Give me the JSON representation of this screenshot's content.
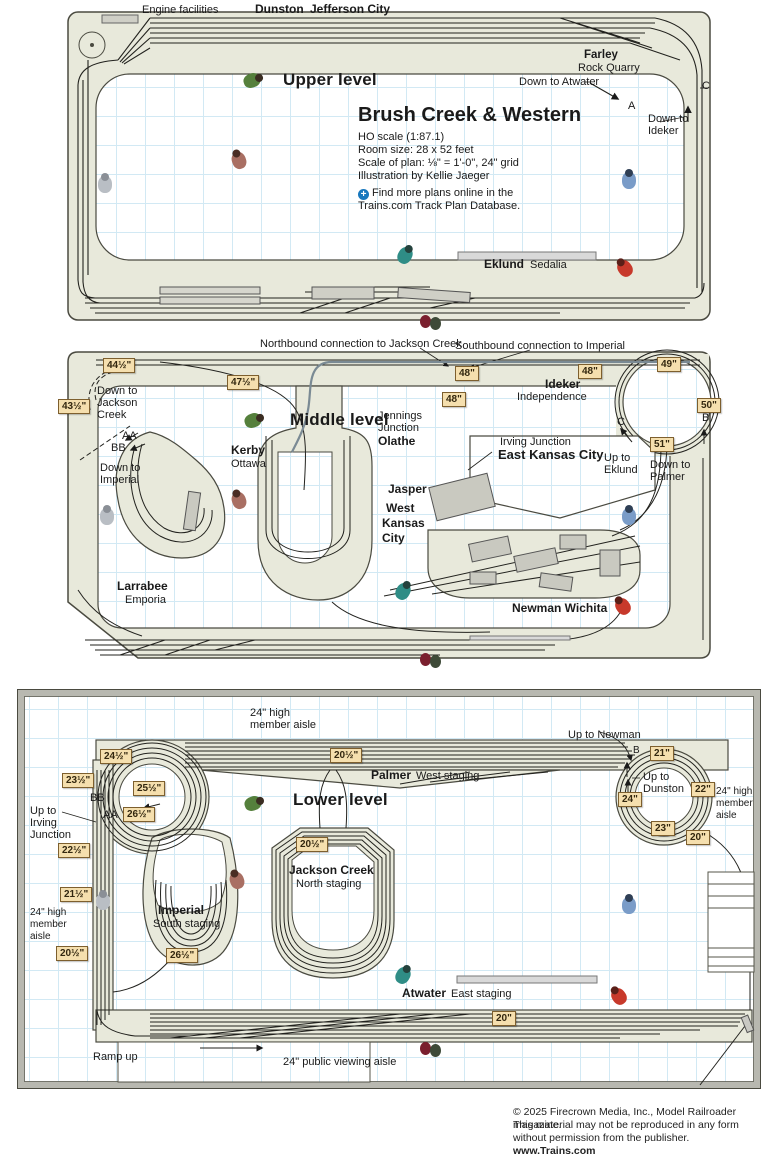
{
  "title_block": {
    "title": "Brush Creek & Western",
    "scale": "HO scale (1:87.1)",
    "room_size": "Room size: 28 x 52 feet",
    "plan_scale": "Scale of plan: ⅛\" = 1'-0\", 24\" grid",
    "illustration": "Illustration by Kellie Jaeger",
    "promo_1": "Find more plans online in the",
    "promo_2": "Trains.com Track Plan Database."
  },
  "glyphs": {
    "plus": "+"
  },
  "colors": {
    "benchwork": "#e8e9db",
    "grid_line": "#d2e9f4",
    "badge_bg": "#f5dfae",
    "badge_border": "#7d5f2e",
    "track": "#22221e",
    "accent_blue": "#1878be"
  },
  "upper": {
    "engine_facilities": "Engine facilities",
    "dunston": "Dunston",
    "jefferson_city": "Jefferson City",
    "level": "Upper level",
    "farley": "Farley",
    "rock_quarry": "Rock Quarry",
    "down_to_atwater": "Down to Atwater",
    "point_a": "A",
    "point_c": "C",
    "down_to_ideker_1": "Down to",
    "down_to_ideker_2": "Ideker",
    "eklund": "Eklund",
    "sedalia": "Sedalia"
  },
  "middle": {
    "level": "Middle level",
    "northbound": "Northbound connection to Jackson Creek",
    "southbound": "Southbound connection to Imperial",
    "b44": "44½\"",
    "b43": "43½\"",
    "b47": "47½\"",
    "b48a": "48\"",
    "b48b": "48\"",
    "b48c": "48\"",
    "b49": "49\"",
    "b50": "50\"",
    "b51": "51\"",
    "down_jackson_1": "Down to",
    "down_jackson_2": "Jackson",
    "down_jackson_3": "Creek",
    "aa": "AA",
    "bb": "BB",
    "down_imperial_1": "Down to",
    "down_imperial_2": "Imperial",
    "kerby": "Kerby",
    "ottawa": "Ottawa",
    "jennings_1": "Jennings",
    "jennings_2": "Junction",
    "olathe": "Olathe",
    "ideker": "Ideker",
    "independence": "Independence",
    "irving": "Irving Junction",
    "east_kc": "East Kansas City",
    "up_eklund_1": "Up to",
    "up_eklund_2": "Eklund",
    "down_palmer_1": "Down to",
    "down_palmer_2": "Palmer",
    "point_b": "B",
    "point_c": "C",
    "jasper": "Jasper",
    "west_kc_1": "West",
    "west_kc_2": "Kansas",
    "west_kc_3": "City",
    "larrabee": "Larrabee",
    "emporia": "Emporia",
    "newman": "Newman  Wichita"
  },
  "lower": {
    "level": "Lower level",
    "aisle_top_1": "24\" high",
    "aisle_top_2": "member aisle",
    "aisle_left_1": "24\" high",
    "aisle_left_2": "member",
    "aisle_left_3": "aisle",
    "aisle_right_1": "24\" high",
    "aisle_right_2": "member",
    "aisle_right_3": "aisle",
    "palmer": "Palmer",
    "west_staging": "West staging",
    "up_newman": "Up to Newman",
    "point_b": "B",
    "point_a": "A",
    "up_dunston_1": "Up to",
    "up_dunston_2": "Dunston",
    "b205_top": "20½\"",
    "b245": "24½\"",
    "b235": "23½\"",
    "b255": "25½\"",
    "b265_left": "26½\"",
    "bb": "BB",
    "aa": "AA",
    "up_irving_1": "Up to",
    "up_irving_2": "Irving",
    "up_irving_3": "Junction",
    "b225": "22½\"",
    "b215": "21½\"",
    "b205_left": "20½\"",
    "b21": "21\"",
    "b22": "22\"",
    "b24": "24\"",
    "b23": "23\"",
    "b20_right": "20\"",
    "b205_jc": "20½\"",
    "jackson_creek": "Jackson Creek",
    "north_staging": "North staging",
    "imperial": "Imperial",
    "south_staging": "South staging",
    "b265_imp": "26½\"",
    "atwater": "Atwater",
    "east_staging": "East staging",
    "b20_bottom": "20\"",
    "ramp_up": "Ramp up",
    "public_aisle": "24\" public viewing aisle"
  },
  "footer": {
    "line1": "© 2025 Firecrown Media, Inc., Model Railroader magazine.",
    "line2": "This material may not be reproduced in any form",
    "line3": "without permission from the publisher.",
    "line4": "www.Trains.com"
  }
}
